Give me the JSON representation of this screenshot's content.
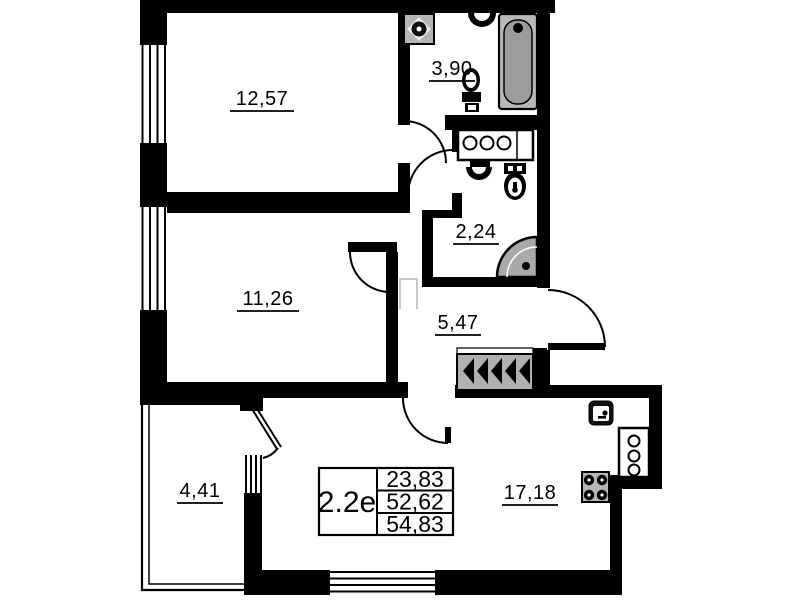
{
  "plan": {
    "unit_type": "2.2e",
    "areas_table": {
      "rows": [
        "23,83",
        "52,62",
        "54,83"
      ]
    },
    "rooms": [
      {
        "name": "bedroom-top",
        "area": "12,57"
      },
      {
        "name": "bathroom",
        "area": "3,90"
      },
      {
        "name": "bedroom-middle",
        "area": "11,26"
      },
      {
        "name": "wc-shower",
        "area": "2,24"
      },
      {
        "name": "hallway",
        "area": "5,47"
      },
      {
        "name": "balcony",
        "area": "4,41"
      },
      {
        "name": "kitchen-living",
        "area": "17,18"
      }
    ],
    "colors": {
      "wall": "#000000",
      "fixture_gray": "#b5b5b5",
      "tub_gray": "#9c9c9c",
      "hatch_gray": "#b0b0b0"
    }
  }
}
